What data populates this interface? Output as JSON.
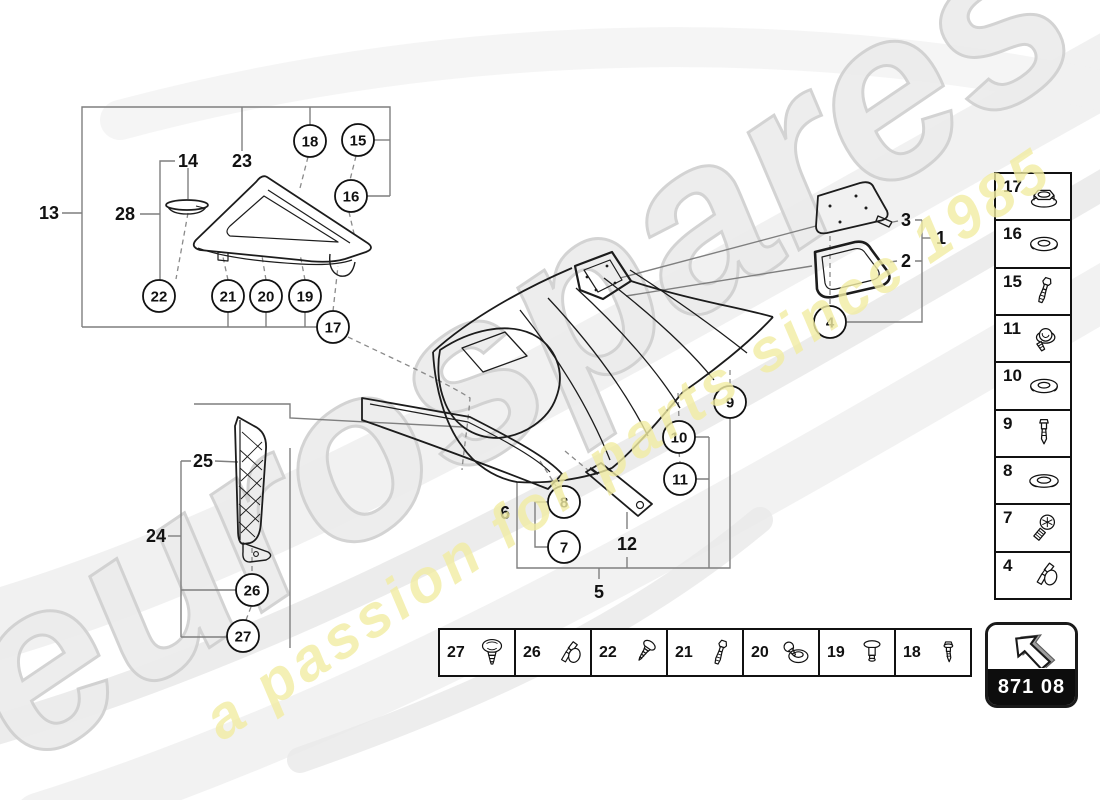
{
  "watermark": {
    "brand": "eurospares",
    "tagline": "a passion for parts since 1985",
    "gray": "#ececec",
    "gray_outline": "#cfcfcf",
    "yellow": "#f2eda3"
  },
  "stamp": {
    "code": "871 08",
    "icon": "arrow-up-left-icon"
  },
  "diagram": {
    "labels": [
      {
        "text": "13",
        "x": 49,
        "y": 213
      },
      {
        "text": "14",
        "x": 188,
        "y": 161
      },
      {
        "text": "23",
        "x": 242,
        "y": 161
      },
      {
        "text": "28",
        "x": 125,
        "y": 214
      },
      {
        "text": "25",
        "x": 203,
        "y": 461
      },
      {
        "text": "24",
        "x": 156,
        "y": 536
      },
      {
        "text": "6",
        "x": 505,
        "y": 513
      },
      {
        "text": "12",
        "x": 627,
        "y": 544
      },
      {
        "text": "5",
        "x": 599,
        "y": 592
      },
      {
        "text": "3",
        "x": 906,
        "y": 220
      },
      {
        "text": "1",
        "x": 941,
        "y": 238
      },
      {
        "text": "2",
        "x": 906,
        "y": 261
      }
    ],
    "callouts": [
      {
        "n": "18",
        "x": 310,
        "y": 141
      },
      {
        "n": "15",
        "x": 358,
        "y": 140
      },
      {
        "n": "16",
        "x": 351,
        "y": 196
      },
      {
        "n": "22",
        "x": 159,
        "y": 296
      },
      {
        "n": "21",
        "x": 228,
        "y": 296
      },
      {
        "n": "20",
        "x": 266,
        "y": 296
      },
      {
        "n": "19",
        "x": 305,
        "y": 296
      },
      {
        "n": "17",
        "x": 333,
        "y": 327
      },
      {
        "n": "26",
        "x": 252,
        "y": 590
      },
      {
        "n": "27",
        "x": 243,
        "y": 636
      },
      {
        "n": "4",
        "x": 830,
        "y": 322
      },
      {
        "n": "9",
        "x": 730,
        "y": 402
      },
      {
        "n": "10",
        "x": 679,
        "y": 437
      },
      {
        "n": "11",
        "x": 680,
        "y": 479
      },
      {
        "n": "8",
        "x": 564,
        "y": 502
      },
      {
        "n": "7",
        "x": 564,
        "y": 547
      }
    ]
  },
  "legend_sidebar": {
    "items": [
      {
        "n": "17",
        "icon": "flange-nut"
      },
      {
        "n": "16",
        "icon": "washer"
      },
      {
        "n": "15",
        "icon": "rivet-pin"
      },
      {
        "n": "11",
        "icon": "screw-washer"
      },
      {
        "n": "10",
        "icon": "washer"
      },
      {
        "n": "9",
        "icon": "pin"
      },
      {
        "n": "8",
        "icon": "flat-washer"
      },
      {
        "n": "7",
        "icon": "torx-screw"
      },
      {
        "n": "4",
        "icon": "clip"
      }
    ]
  },
  "legend_bottom": {
    "items": [
      {
        "n": "27",
        "icon": "pan-screw"
      },
      {
        "n": "26",
        "icon": "clip"
      },
      {
        "n": "22",
        "icon": "tapping-screw"
      },
      {
        "n": "21",
        "icon": "rivet-pin"
      },
      {
        "n": "20",
        "icon": "grommet-screw"
      },
      {
        "n": "19",
        "icon": "push-pin"
      },
      {
        "n": "18",
        "icon": "small-rivet"
      }
    ]
  }
}
